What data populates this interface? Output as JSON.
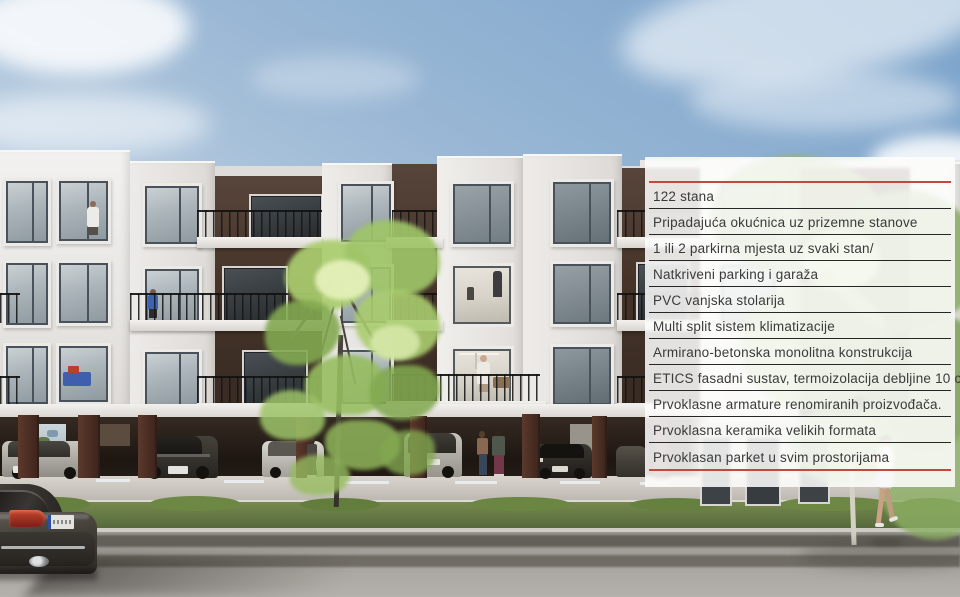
{
  "features": {
    "items": [
      "122 stana",
      "Pripadajuća okućnica uz prizemne stanove",
      "1 ili 2 parkirna mjesta uz svaki stan/",
      "Natkriveni parking i garaža",
      "PVC vanjska stolarija",
      "Multi split sistem klimatizacije",
      "Armirano-betonska monolitna konstrukcija",
      "ETICS fasadni sustav, termoizolacija debljine 10 cm",
      "Prvoklasne armature renomiranih proizvođača.",
      "Prvoklasna keramika velikih formata",
      "Prvoklasan parket u svim prostorijama"
    ],
    "accent_color": "#c7473e",
    "divider_color": "#262626",
    "text_color": "#3a3a3a"
  }
}
